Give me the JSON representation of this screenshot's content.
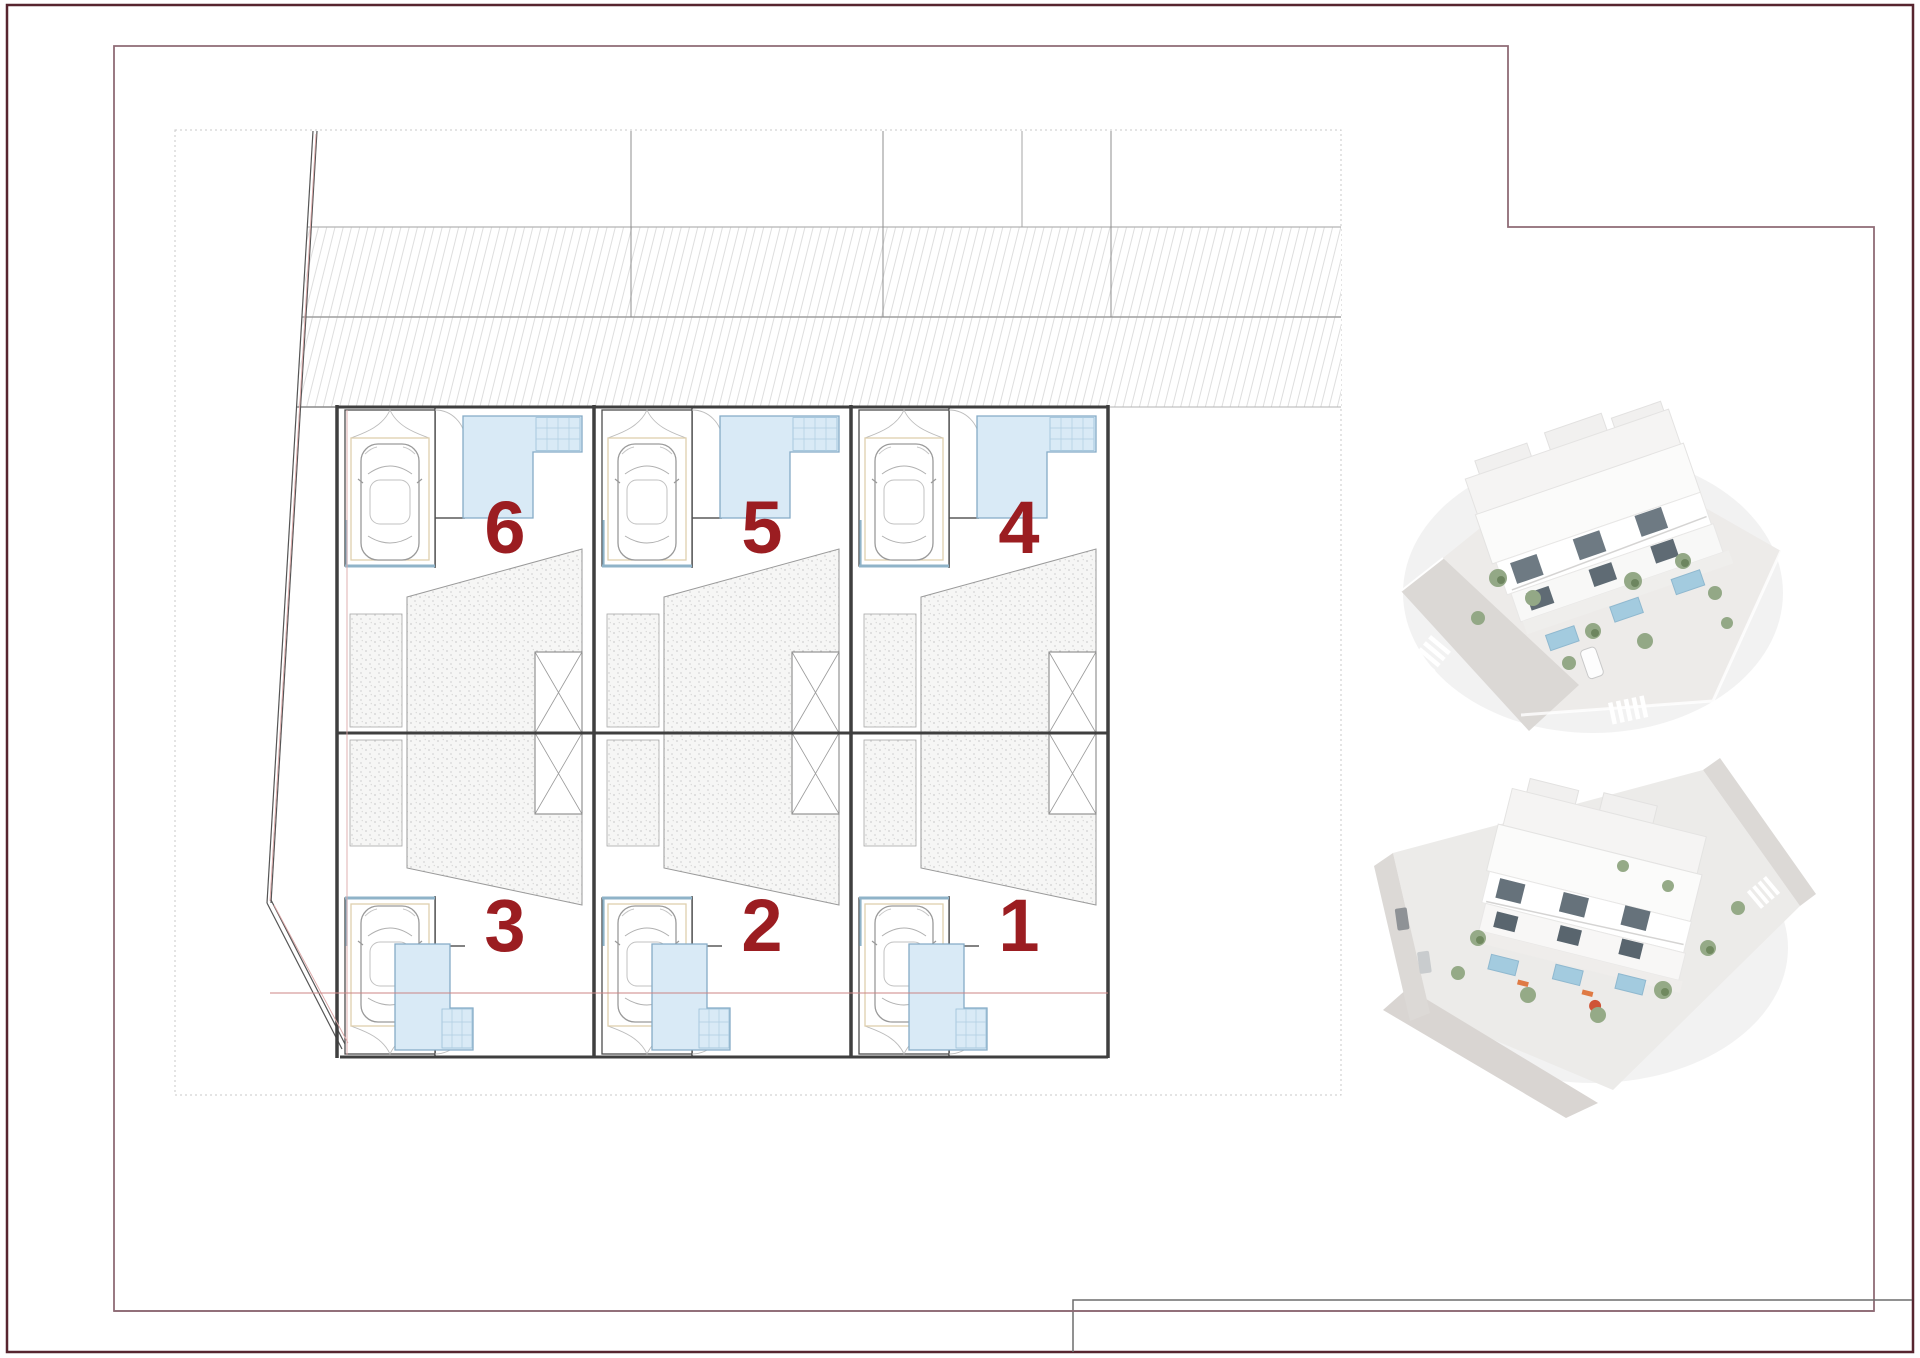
{
  "document": {
    "kind": "architectural site plan sheet",
    "sheet_background": "#ffffff"
  },
  "units": [
    {
      "label": "6"
    },
    {
      "label": "5"
    },
    {
      "label": "4"
    },
    {
      "label": "3"
    },
    {
      "label": "2"
    },
    {
      "label": "1"
    }
  ],
  "plan": {
    "unit_rows": {
      "top_row_labels": [
        "6",
        "5",
        "4"
      ],
      "bottom_row_labels": [
        "3",
        "2",
        "1"
      ]
    },
    "number_color": "#9b1d21",
    "pool_fill": "#d9eaf6",
    "pool_edge": "#85abc6",
    "stipple_dot_color": "#cfcfcf",
    "hatch_color": "#dedede",
    "wall_color": "#3f3f3f",
    "parking_trim_color": "#dfcfae",
    "parking_accent_color": "#8fb3c8",
    "boundary_overlay_red": "#d09090"
  },
  "frame": {
    "outer_border_color": "#57252f",
    "inner_frame_color": "#8f6b76",
    "title_block_line_color": "#6d6d6d"
  },
  "icons": [
    {
      "name": "car-top-view-icon",
      "meaning": "parking space with car"
    },
    {
      "name": "pool-steps-icon",
      "meaning": "swimming pool stair grid"
    },
    {
      "name": "elevator-shaft-icon",
      "meaning": "crossed-box shaft symbol"
    },
    {
      "name": "door-swing-icon",
      "meaning": "entrance door arc"
    }
  ],
  "renders": [
    {
      "position": "top"
    },
    {
      "position": "bottom"
    }
  ]
}
